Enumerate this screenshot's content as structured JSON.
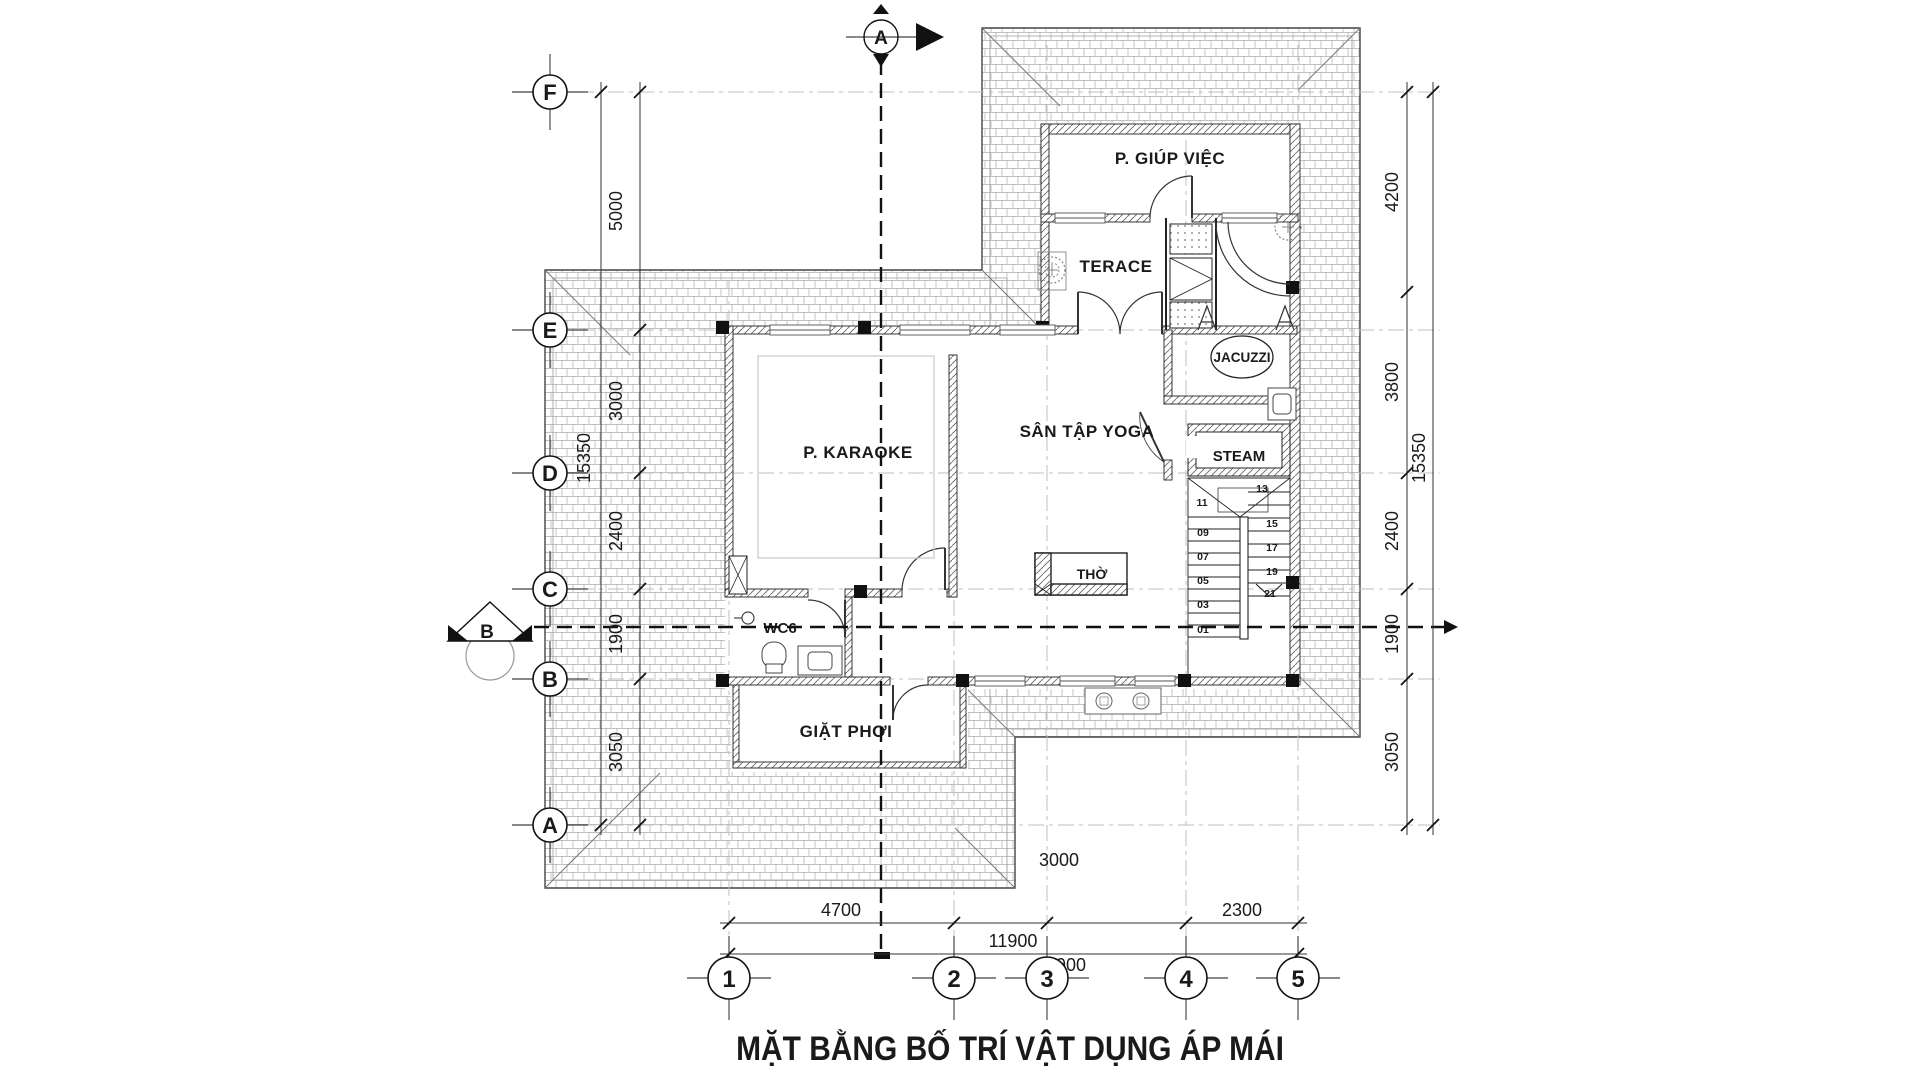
{
  "title": "MẶT BẰNG BỐ TRÍ VẬT DỤNG ÁP MÁI",
  "grid": {
    "rows": [
      "F",
      "E",
      "D",
      "C",
      "B",
      "A"
    ],
    "cols": [
      "1",
      "2",
      "3",
      "4",
      "5"
    ]
  },
  "sections": {
    "a": "A",
    "b": "B"
  },
  "rooms": {
    "giup_viec": "P. GIÚP VIỆC",
    "terace": "TERACE",
    "jacuzzi": "JACUZZI",
    "steam": "STEAM",
    "yoga": "SÂN TẬP YOGA",
    "karaoke": "P. KARAOKE",
    "tho": "THỜ",
    "wc": "WC6",
    "giat_phoi": "GIẶT PHƠI"
  },
  "dims": {
    "left_chain": [
      "5000",
      "3000",
      "2400",
      "1900",
      "3050"
    ],
    "left_total": "15350",
    "right_chain": [
      "4200",
      "3800",
      "2400",
      "1900",
      "3050"
    ],
    "right_total": "15350",
    "bottom_chain": [
      "4700",
      "1900",
      "3000",
      "2300"
    ],
    "bottom_total": "11900"
  },
  "stairs": {
    "steps": [
      "01",
      "03",
      "05",
      "07",
      "09",
      "11",
      "13",
      "15",
      "17",
      "19",
      "21"
    ]
  },
  "colors": {
    "ink": "#1a1a1a",
    "wall_hatch": "#666666",
    "roof_line": "#444444",
    "roof_tile": "#adadad",
    "grid_line": "#bfbfbf",
    "dim_line": "#333333",
    "paper": "#ffffff"
  }
}
